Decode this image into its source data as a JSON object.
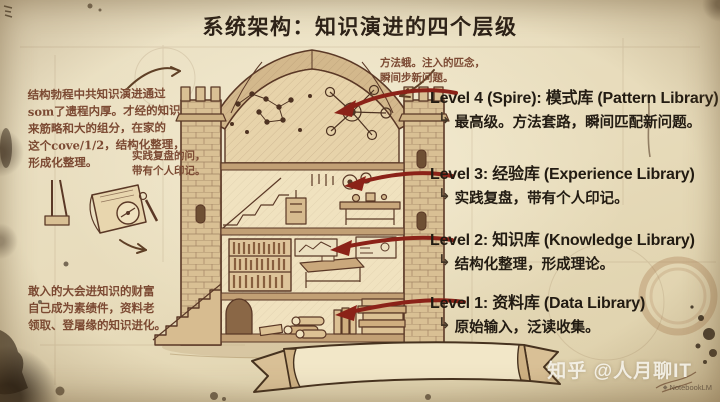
{
  "title": "系统架构：知识演进的四个层级",
  "levels": [
    {
      "heading": "Level 4 (Spire): 模式库 (Pattern Library)",
      "hook": "↳",
      "desc": "最高级。方法套路，瞬间匹配新问题。"
    },
    {
      "heading": "Level 3: 经验库 (Experience Library)",
      "hook": "↳",
      "desc": "实践复盘，带有个人印记。"
    },
    {
      "heading": "Level 2: 知识库 (Knowledge Library)",
      "hook": "↳",
      "desc": "结构化整理，形成理论。"
    },
    {
      "heading": "Level 1: 资料库 (Data Library)",
      "hook": "↳",
      "desc": "原始输入，泛读收集。"
    }
  ],
  "annotations": {
    "top_left": "结构勃程中共知识演进通过\nsom了遗程内厚。才经的知识\n来筋略和大的组分，在家的\n这个cove/1/2，结构化整理，\n形成化整理。",
    "mid_left": "实践复盘的问，\n带有个人印记。",
    "bottom_left": "敢入的大会进知识的财富\n自己成为素绩件，资料老\n领取、登屠缘的知识进化。",
    "spire_note": "方法蛾。注入的匹念，\n瞬间步新问题。"
  },
  "watermarks": {
    "zhihu": "知乎 @人月聊IT",
    "notebooklm": "NotebookLM",
    "nblm_dot": "◆"
  },
  "colors": {
    "paper": "#e9dfc4",
    "ink": "#2d2218",
    "sketch_brown": "#5a3826",
    "hand_note": "#7c4a33",
    "red_arrow": "#8b2218"
  }
}
